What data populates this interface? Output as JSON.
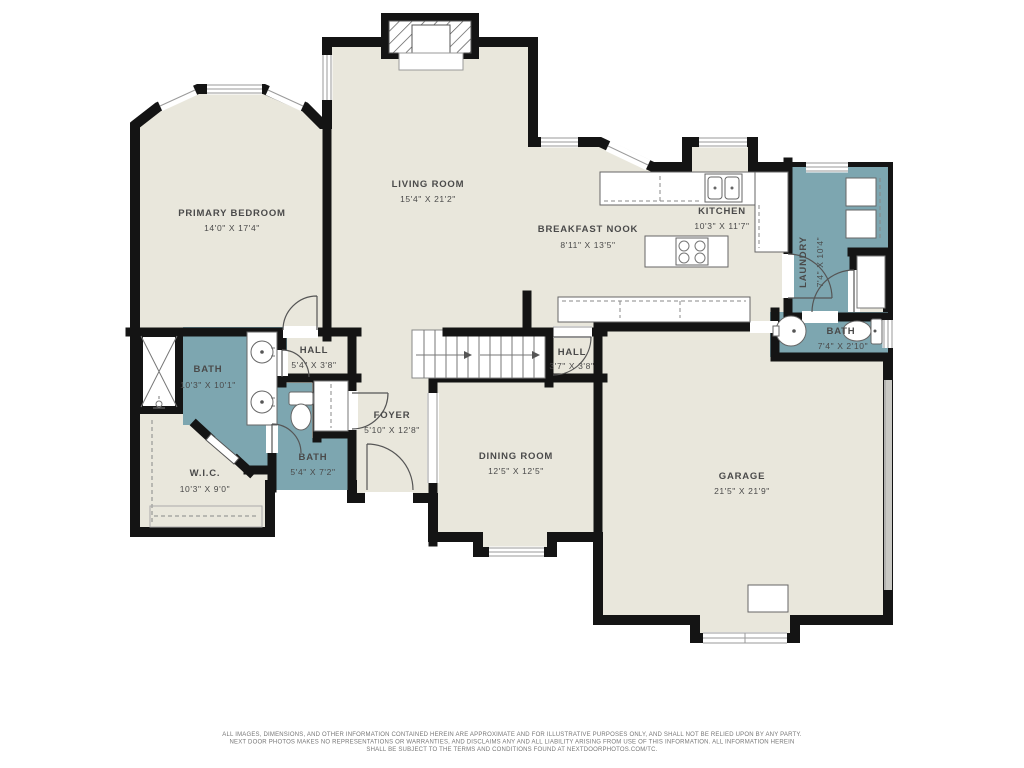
{
  "colors": {
    "floor": "#e9e7dc",
    "wet": "#7da6b0",
    "wall": "#141414",
    "window_line": "#9a9a9a",
    "garage_door": "#c9c9c4",
    "text": "#4a4a4a"
  },
  "rooms": [
    {
      "name": "PRIMARY BEDROOM",
      "dims": "14'0\" X 17'4\""
    },
    {
      "name": "LIVING ROOM",
      "dims": "15'4\" X 21'2\""
    },
    {
      "name": "BREAKFAST NOOK",
      "dims": "8'11\" X 13'5\""
    },
    {
      "name": "KITCHEN",
      "dims": "10'3\" X 11'7\""
    },
    {
      "name": "LAUNDRY",
      "dims": "7'4\" X 10'4\""
    },
    {
      "name": "BATH",
      "dims": "7'4\" X 2'10\""
    },
    {
      "name": "HALL",
      "dims": "5'4\" X 3'8\""
    },
    {
      "name": "HALL",
      "dims": "3'7\" X 3'8\""
    },
    {
      "name": "BATH",
      "dims": "10'3\" X 10'1\""
    },
    {
      "name": "FOYER",
      "dims": "5'10\" X 12'8\""
    },
    {
      "name": "BATH",
      "dims": "5'4\" X 7'2\""
    },
    {
      "name": "W.I.C.",
      "dims": "10'3\" X 9'0\""
    },
    {
      "name": "DINING ROOM",
      "dims": "12'5\" X 12'5\""
    },
    {
      "name": "GARAGE",
      "dims": "21'5\" X 21'9\""
    }
  ],
  "footer": {
    "line1": "ALL IMAGES, DIMENSIONS, AND OTHER INFORMATION CONTAINED HEREIN ARE APPROXIMATE AND FOR ILLUSTRATIVE PURPOSES ONLY, AND SHALL NOT BE RELIED UPON BY ANY PARTY.",
    "line2": "NEXT DOOR PHOTOS MAKES NO REPRESENTATIONS OR WARRANTIES, AND DISCLAIMS ANY AND ALL LIABILITY ARISING FROM USE OF THIS INFORMATION. ALL INFORMATION HEREIN",
    "line3": "SHALL BE SUBJECT TO THE TERMS AND CONDITIONS FOUND AT NEXTDOORPHOTOS.COM/TC."
  }
}
